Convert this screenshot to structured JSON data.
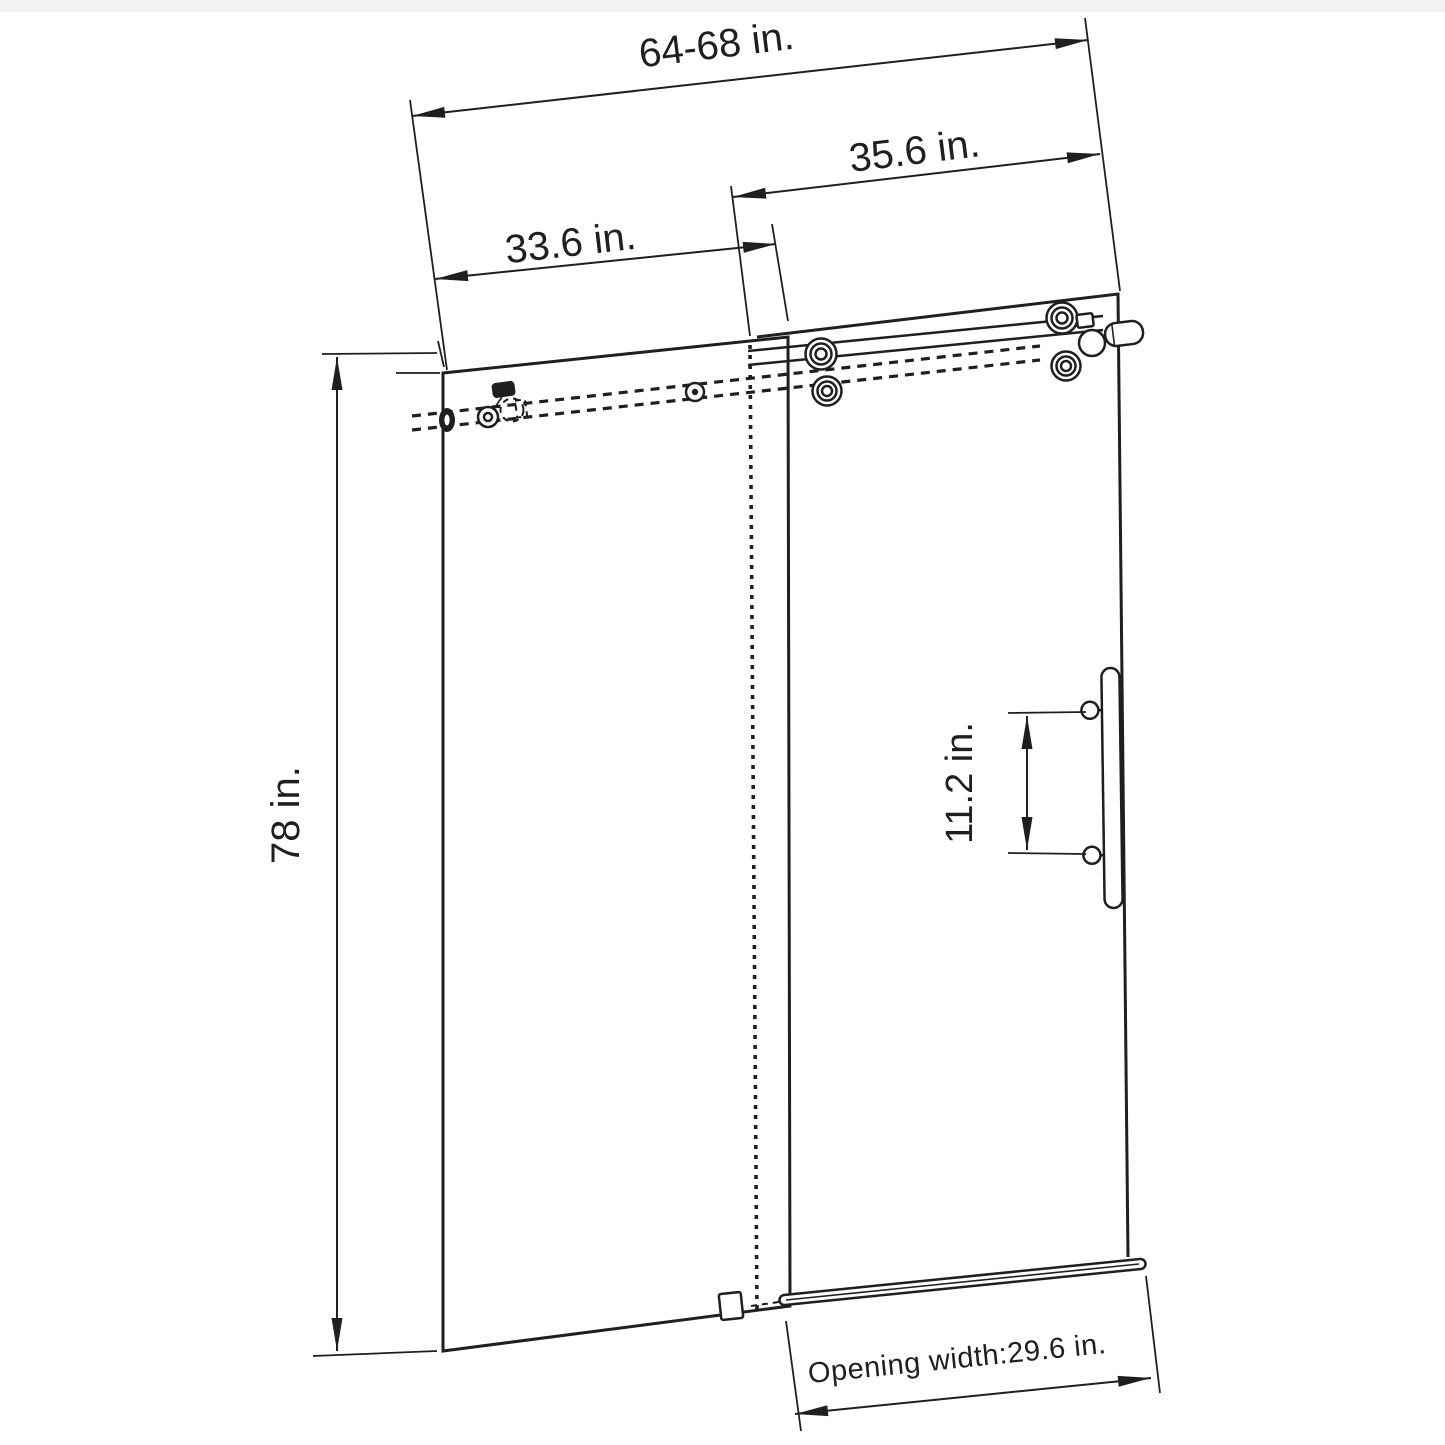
{
  "page": {
    "background": "#ffffff",
    "top_strip_color": "#f2f2f2",
    "ink_color": "#1f1f1f"
  },
  "diagram": {
    "labels": {
      "overall_width": "64-68 in.",
      "door_panel_width": "35.6 in.",
      "fixed_panel_width": "33.6 in.",
      "height": "78 in.",
      "handle_spacing": "11.2 in.",
      "opening_width": "Opening width:29.6 in."
    }
  }
}
